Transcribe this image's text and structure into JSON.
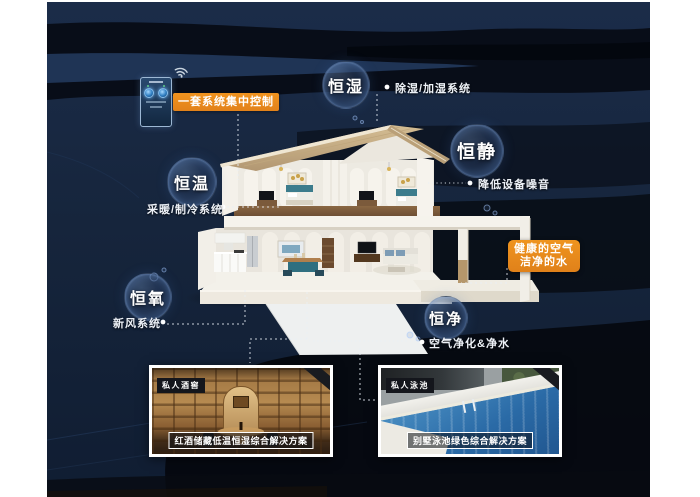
{
  "colors": {
    "background_navy": "#16253c",
    "accent_orange": "#e8891d",
    "text_white": "#ffffff"
  },
  "control": {
    "label": "一套系统集中控制"
  },
  "bubbles": {
    "humidity": {
      "label": "恒湿",
      "note": "除湿/加湿系统"
    },
    "quiet": {
      "label": "恒静",
      "note": "降低设备噪音"
    },
    "temperature": {
      "label": "恒温",
      "note": "采暖/制冷系统"
    },
    "oxygen": {
      "label": "恒氧",
      "note": "新风系统"
    },
    "purity": {
      "label": "恒净",
      "note": "空气净化&净水"
    }
  },
  "callout": {
    "line1": "健康的空气",
    "line2": "洁净的水"
  },
  "photos": {
    "wine": {
      "tag": "私人酒窖",
      "caption": "红酒储藏低温恒湿综合解决方案"
    },
    "pool": {
      "tag": "私人泳池",
      "caption": "别墅泳池绿色综合解决方案"
    }
  }
}
